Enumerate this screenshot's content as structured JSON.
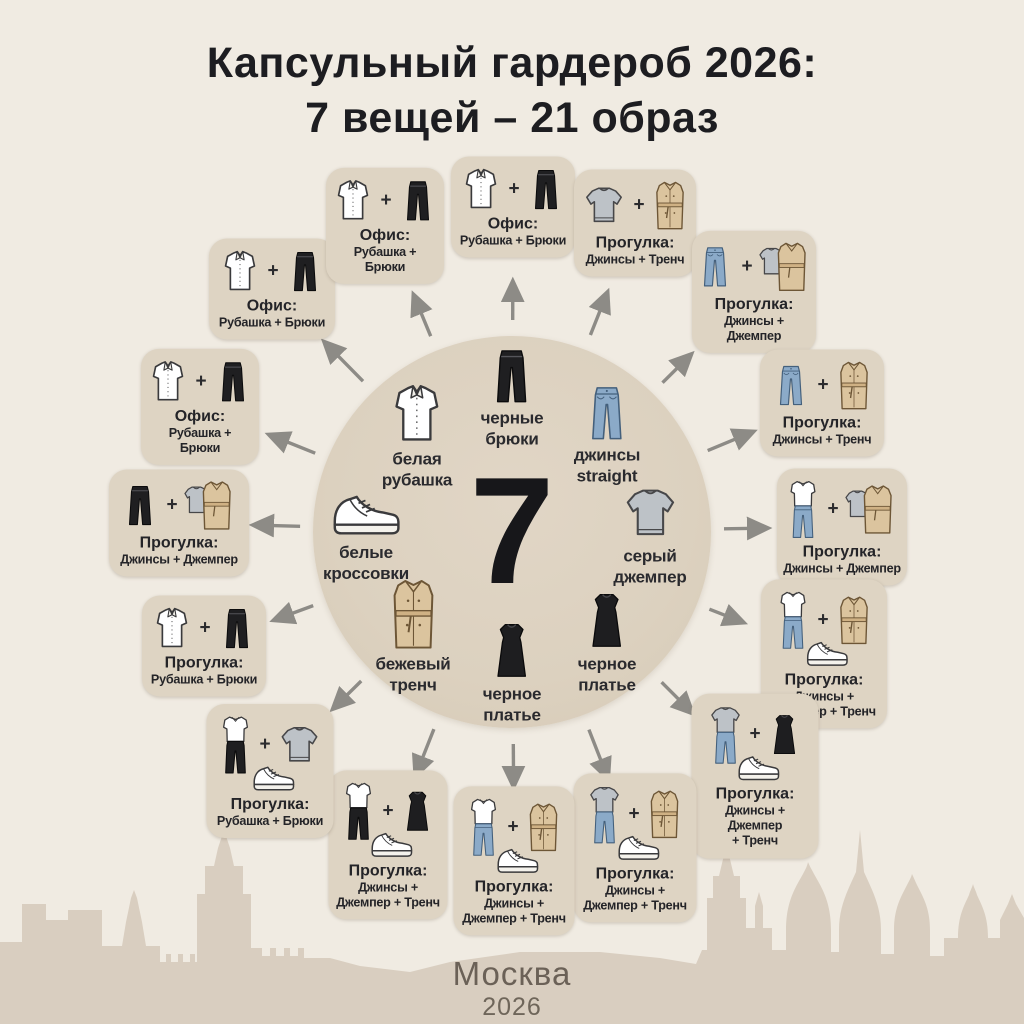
{
  "title": {
    "line1": "Капсульный гардероб 2026:",
    "line2": "7 вещей – 21 образ"
  },
  "center": {
    "number": "7",
    "items": [
      {
        "icon": "shirt",
        "label": "белая\nрубашка"
      },
      {
        "icon": "pants",
        "label": "черные\nбрюки"
      },
      {
        "icon": "jeans",
        "label": "джинсы\nstraight"
      },
      {
        "icon": "sneaker",
        "label": "белые\nкроссовки"
      },
      {
        "icon": "sweater",
        "label": "серый\nджемпер"
      },
      {
        "icon": "trench",
        "label": "бежевый\nтренч"
      },
      {
        "icon": "dress",
        "label": "черное\nплатье"
      },
      {
        "icon": "dress",
        "label": "черное\nплатье"
      }
    ]
  },
  "plus": "+",
  "cards": [
    {
      "x": 272,
      "y": 289,
      "w": 114,
      "title": "Офис:",
      "lines": [
        "Рубашка + Брюки"
      ],
      "icons": [
        "shirt",
        "pants"
      ]
    },
    {
      "x": 385,
      "y": 226,
      "w": 106,
      "title": "Офис:",
      "lines": [
        "Рубашка + Брюки"
      ],
      "icons": [
        "shirt",
        "pants"
      ]
    },
    {
      "x": 513,
      "y": 207,
      "w": 112,
      "title": "Офис:",
      "lines": [
        "Рубашка + Брюки"
      ],
      "icons": [
        "shirt",
        "pants"
      ]
    },
    {
      "x": 635,
      "y": 223,
      "w": 110,
      "title": "Прогулка:",
      "lines": [
        "Джинсы + Тренч"
      ],
      "icons": [
        "sweater",
        "trench"
      ]
    },
    {
      "x": 754,
      "y": 292,
      "w": 112,
      "title": "Прогулка:",
      "lines": [
        "Джинсы + Джемпер"
      ],
      "icons": [
        "jeans",
        "sweater-trench"
      ],
      "gap": 88
    },
    {
      "x": 822,
      "y": 403,
      "w": 112,
      "title": "Прогулка:",
      "lines": [
        "Джинсы + Тренч"
      ],
      "icons": [
        "jeans",
        "trench"
      ]
    },
    {
      "x": 842,
      "y": 527,
      "w": 118,
      "title": "Прогулка:",
      "lines": [
        "Джинсы + Джемпер"
      ],
      "icons": [
        "outfit-shirt-jeans",
        "sweater-trench"
      ]
    },
    {
      "x": 824,
      "y": 654,
      "w": 114,
      "title": "Прогулка:",
      "lines": [
        "Джинсы +",
        "Джемпер + Тренч"
      ],
      "icons": [
        "outfit-shirt-jeans",
        "trench"
      ],
      "extra": "sneaker",
      "gap": 86
    },
    {
      "x": 755,
      "y": 776,
      "w": 115,
      "title": "Прогулка:",
      "lines": [
        "Джинсы + Джемпер",
        "+ Тренч"
      ],
      "icons": [
        "outfit-sweater-jeans",
        "dress"
      ],
      "extra": "sneaker",
      "gap": 88
    },
    {
      "x": 635,
      "y": 848,
      "w": 111,
      "title": "Прогулка:",
      "lines": [
        "Джинсы +",
        "Джемпер + Тренч"
      ],
      "icons": [
        "outfit-sweater-jeans",
        "trench"
      ],
      "extra": "sneaker"
    },
    {
      "x": 514,
      "y": 861,
      "w": 109,
      "title": "Прогулка:",
      "lines": [
        "Джинсы +",
        "Джемпер + Тренч"
      ],
      "icons": [
        "outfit-shirt-jeans",
        "trench"
      ],
      "extra": "sneaker"
    },
    {
      "x": 388,
      "y": 845,
      "w": 107,
      "title": "Прогулка:",
      "lines": [
        "Джинсы +",
        "Джемпер + Тренч"
      ],
      "icons": [
        "outfit-shirt-pants",
        "dress"
      ],
      "extra": "sneaker"
    },
    {
      "x": 270,
      "y": 771,
      "w": 115,
      "title": "Прогулка:",
      "lines": [
        "Рубашка + Брюки"
      ],
      "icons": [
        "outfit-shirt-pants",
        "sweater"
      ],
      "extra": "sneaker",
      "gap": 88
    },
    {
      "x": 204,
      "y": 646,
      "w": 112,
      "title": "Прогулка:",
      "lines": [
        "Рубашка + Брюки"
      ],
      "icons": [
        "shirt",
        "pants"
      ]
    },
    {
      "x": 179,
      "y": 523,
      "w": 128,
      "title": "Прогулка:",
      "lines": [
        "Джинсы + Джемпер"
      ],
      "icons": [
        "pants",
        "sweater-trench"
      ]
    },
    {
      "x": 200,
      "y": 407,
      "w": 106,
      "title": "Офис:",
      "lines": [
        "Рубашка + Брюки"
      ],
      "icons": [
        "shirt",
        "pants"
      ]
    }
  ],
  "footer": {
    "city": "Москва",
    "year": "2026"
  },
  "colors": {
    "background": "#f0ebe2",
    "circle": "#ddd2c0",
    "card": "#ded4c3",
    "arrow": "#8d8b86",
    "text": "#242428",
    "skyline": "#d9cec0"
  }
}
